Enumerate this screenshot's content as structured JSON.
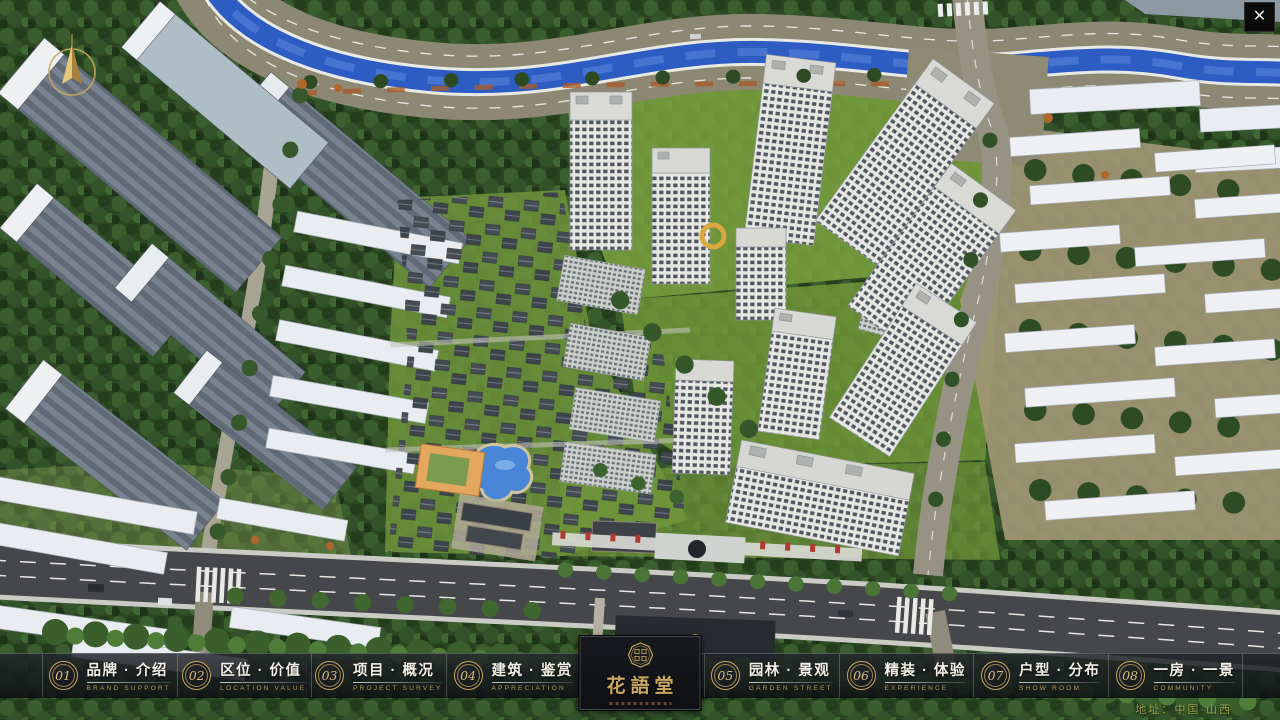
{
  "app": {
    "close_glyph": "✕"
  },
  "nav": {
    "items": [
      {
        "num": "01",
        "label": "品牌 · 介绍",
        "sub": "BRAND SUPPORT"
      },
      {
        "num": "02",
        "label": "区位 · 价值",
        "sub": "LOCATION VALUE"
      },
      {
        "num": "03",
        "label": "项目 · 概况",
        "sub": "PROJECT SURVEY"
      },
      {
        "num": "04",
        "label": "建筑 · 鉴赏",
        "sub": "APPRECIATION"
      },
      {
        "num": "05",
        "label": "园林 · 景观",
        "sub": "GARDEN STREET"
      },
      {
        "num": "06",
        "label": "精装 · 体验",
        "sub": "EXPERIENCE"
      },
      {
        "num": "07",
        "label": "户型 · 分布",
        "sub": "SHOW ROOM"
      },
      {
        "num": "08",
        "label": "一房 · 一景",
        "sub": "COMMUNITY"
      }
    ]
  },
  "logo": {
    "title": "花語堂"
  },
  "footer": {
    "address": "地址：中国·山西"
  },
  "colors": {
    "accent_gold": "#c9a85e",
    "bar_background": "#14161a",
    "address_text": "#99a14f",
    "river_blue": "#2d5cc2"
  }
}
